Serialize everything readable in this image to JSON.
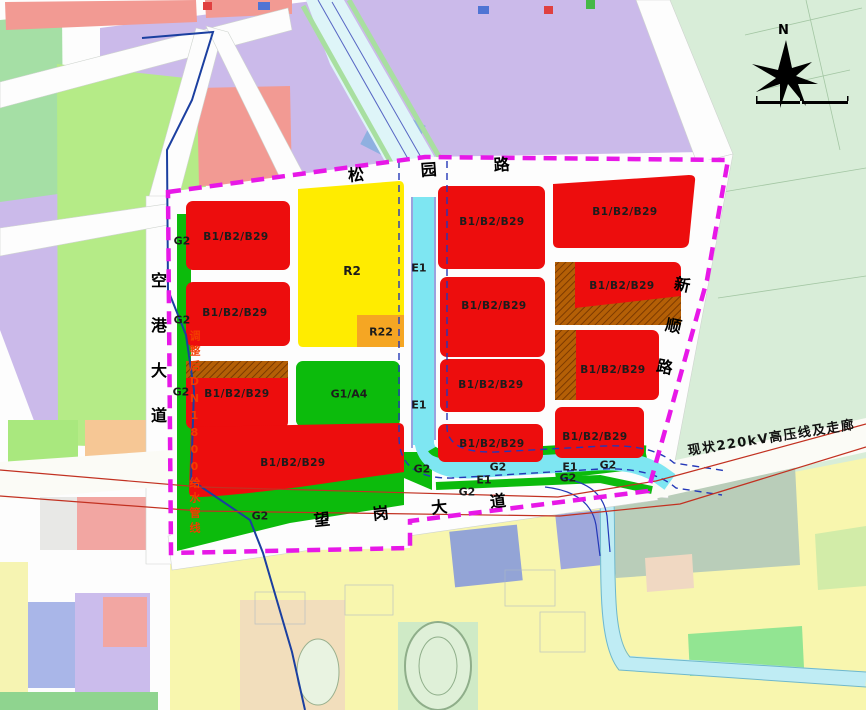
{
  "map": {
    "parcel_labels": {
      "commercial_mixed": "B1/B2/B29",
      "residential": "R2",
      "residential_sub": "R22",
      "park_civic": "G1/A4",
      "green_space": "G2",
      "waterway": "E1"
    },
    "road_labels": {
      "songyuan_road": "松园路",
      "wanggang_avenue": "望岗大道",
      "konggang_avenue": "空港大道",
      "xinshun_road": "新顺路"
    },
    "annotations": {
      "power_corridor": "现状220kV高压线及走廊",
      "water_pipeline": "调整后DN1800给水管线",
      "compass_north": "N"
    },
    "colors": {
      "commercial_red": "#ed0d0d",
      "residential_yellow": "#ffec00",
      "residential_orange": "#f5a623",
      "green": "#0cbb0c",
      "water_cyan": "#7ee6f2",
      "boundary_magenta": "#e718e7",
      "hatch_brown": "#b45f06"
    }
  }
}
